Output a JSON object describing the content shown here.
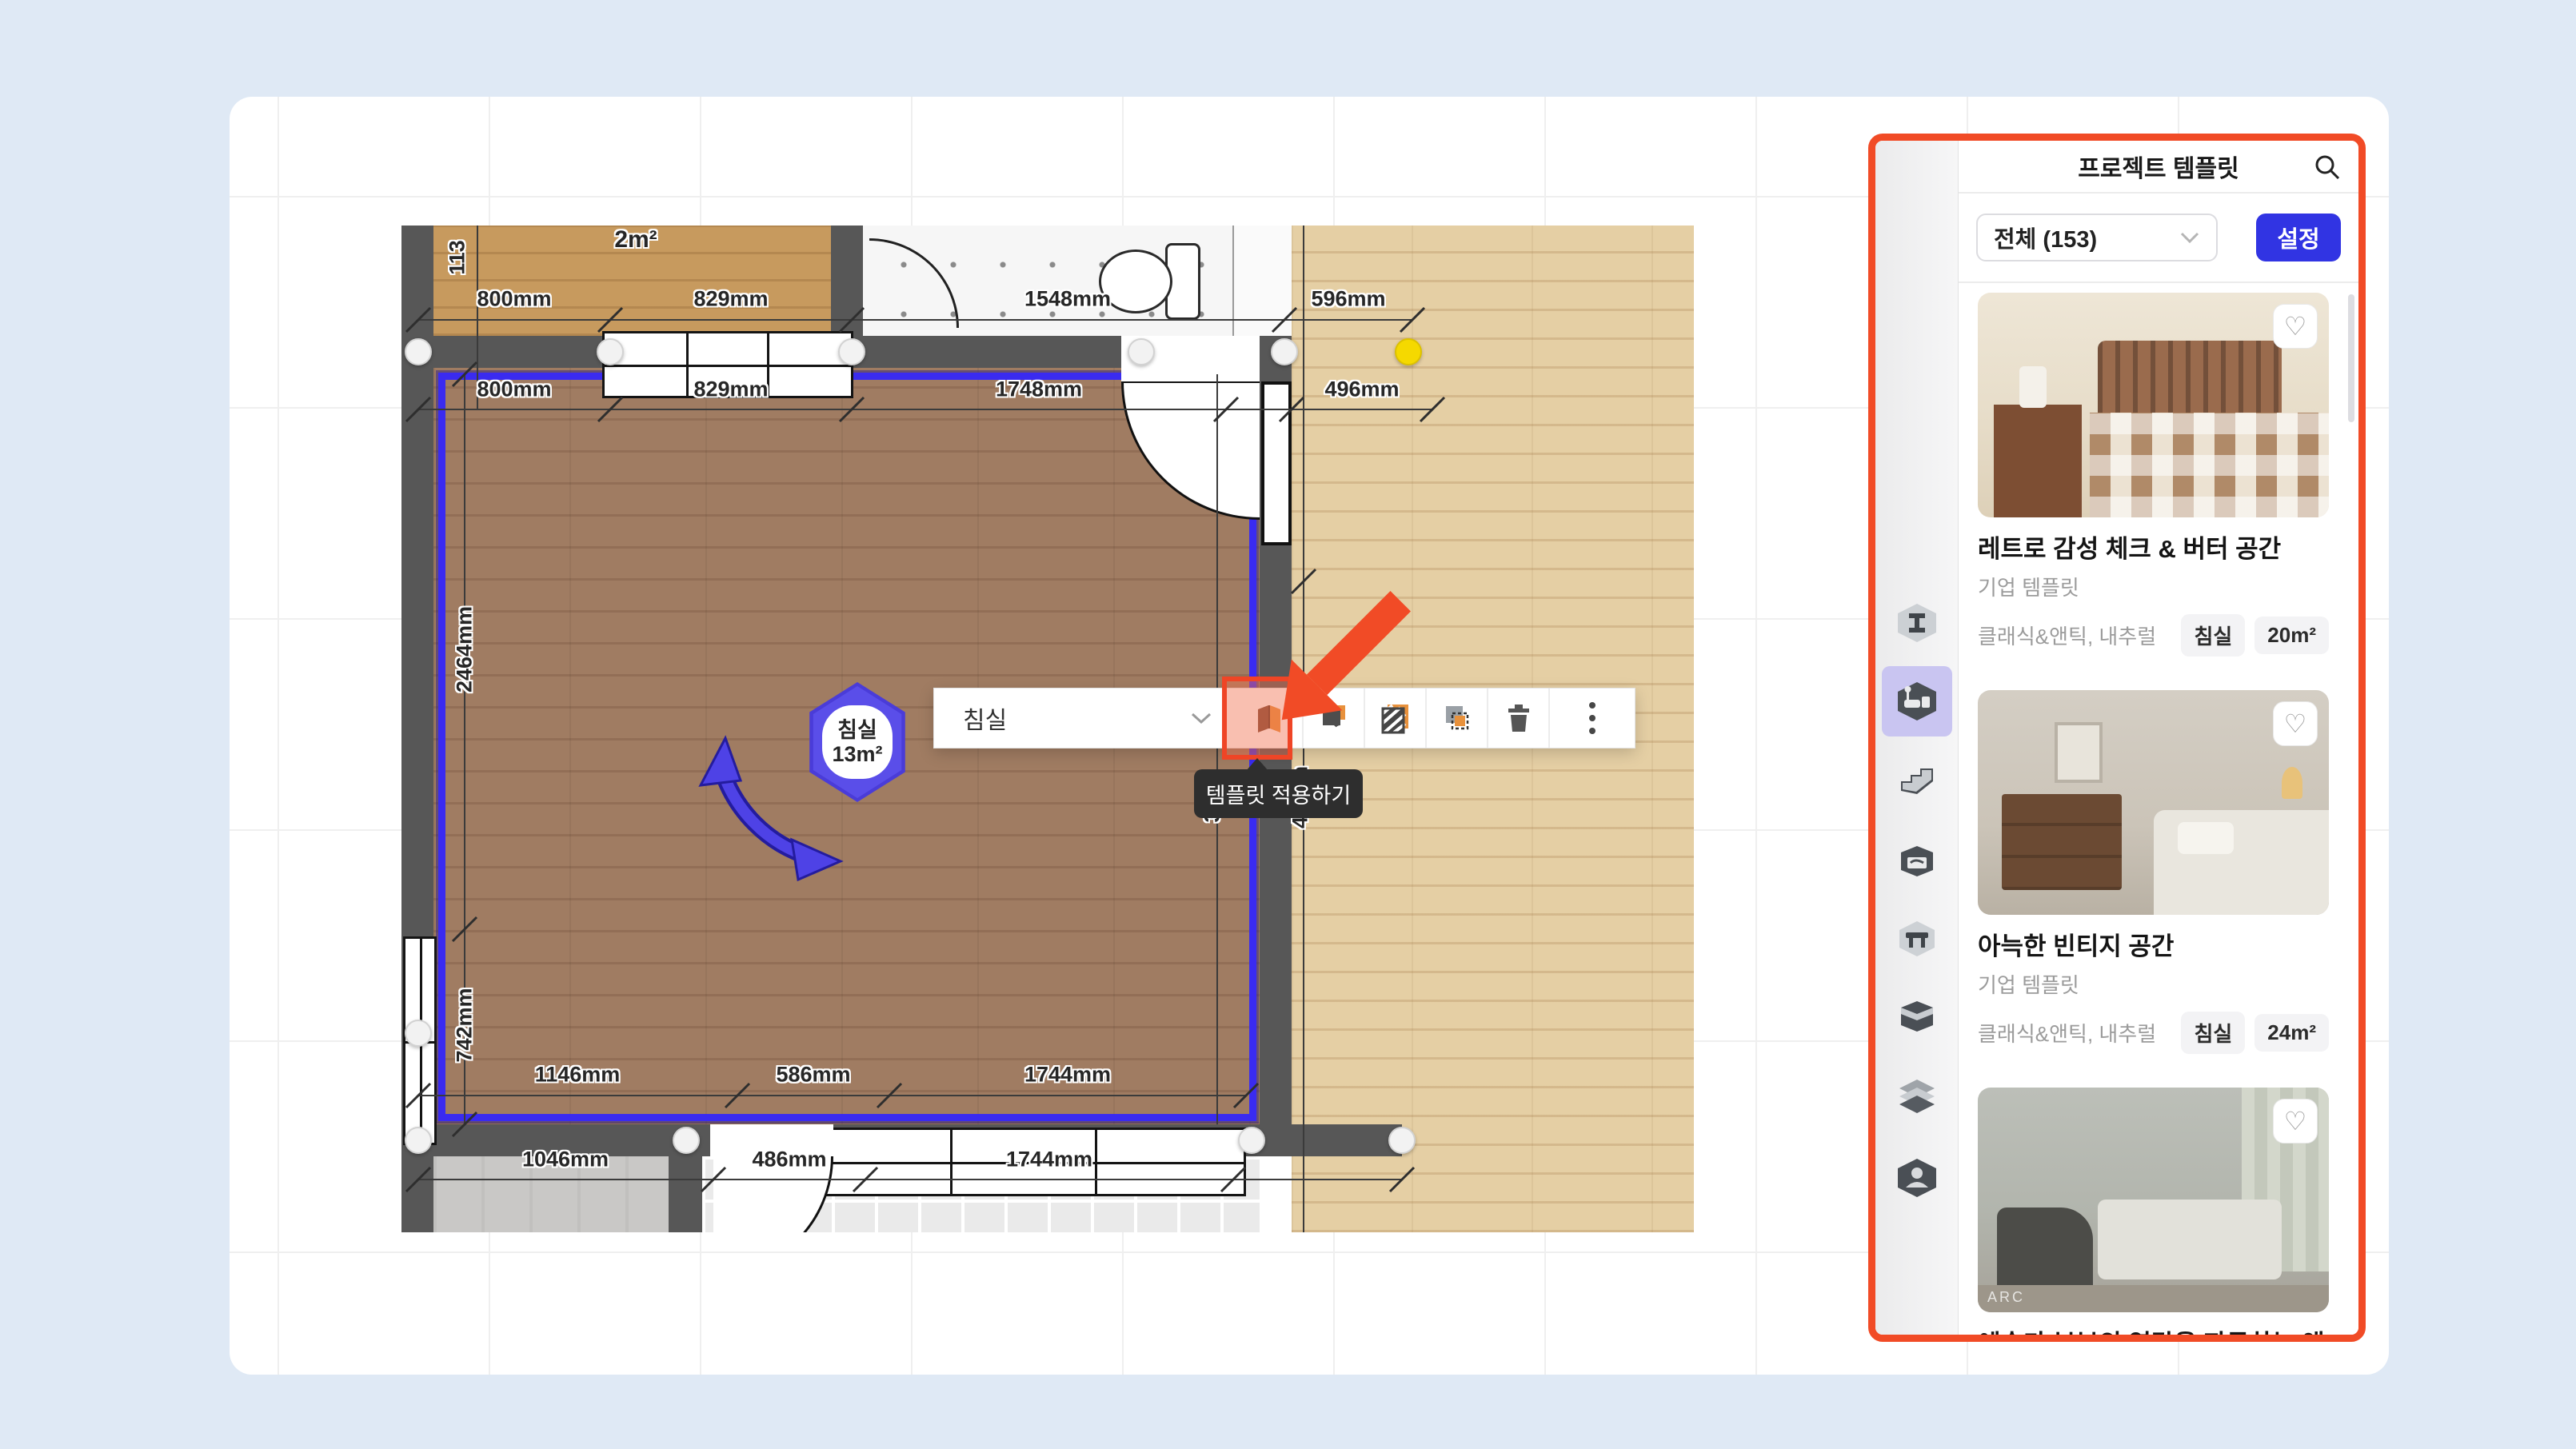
{
  "colors": {
    "annotation_orange": "#f14b26",
    "selection_blue": "#3a2bf0",
    "hexagon_purple": "#5a4ee9",
    "settings_button_blue": "#3134e3",
    "sidebar_selected_lavender": "#c9c5f1",
    "node_yellow": "#f5d900"
  },
  "plan": {
    "room_badge": {
      "label": "침실",
      "area": "13m²"
    },
    "top_room_area": "2m²",
    "dimensions": {
      "top_outer": [
        "800mm",
        "829mm",
        "1548mm",
        "596mm"
      ],
      "top_inner": [
        "800mm",
        "829mm",
        "1748mm",
        "496mm"
      ],
      "bottom_inner": [
        "1146mm",
        "586mm",
        "1744mm"
      ],
      "bottom_outer": [
        "1046mm",
        "486mm",
        "1744mm"
      ],
      "left_vertical": [
        "2464mm",
        "742mm"
      ],
      "fragments": [
        "113",
        "3mm",
        "43mm"
      ]
    }
  },
  "toolbar": {
    "room_select": "침실",
    "tooltip": "템플릿 적용하기",
    "icons": [
      "apply-template",
      "save-room",
      "material",
      "duplicate",
      "delete",
      "more"
    ]
  },
  "panel": {
    "title": "프로젝트 템플릿",
    "search_icon": "search-icon",
    "filter_label": "전체 (153)",
    "settings_label": "설정",
    "templates": [
      {
        "title": "레트로 감성 체크 & 버터 공간",
        "subtitle": "기업 템플릿",
        "style": "클래식&앤틱, 내추럴",
        "room_badge": "침실",
        "area_badge": "20m²"
      },
      {
        "title": "아늑한 빈티지 공간",
        "subtitle": "기업 템플릿",
        "style": "클래식&앤틱, 내추럴",
        "room_badge": "침실",
        "area_badge": "24m²"
      },
      {
        "title": "예술가 부부의 영감을 자극하는 앤틱한 침실",
        "subtitle": "기업 템플릿",
        "style": "클래식&앤틱, 내추럴",
        "room_badge": "침실",
        "area_badge": "12m²",
        "watermark": "ARC"
      }
    ]
  },
  "sidebar_icons": [
    "build-material",
    "room-template",
    "stairs",
    "toolbox",
    "furniture",
    "storage-box",
    "layers",
    "profile"
  ]
}
